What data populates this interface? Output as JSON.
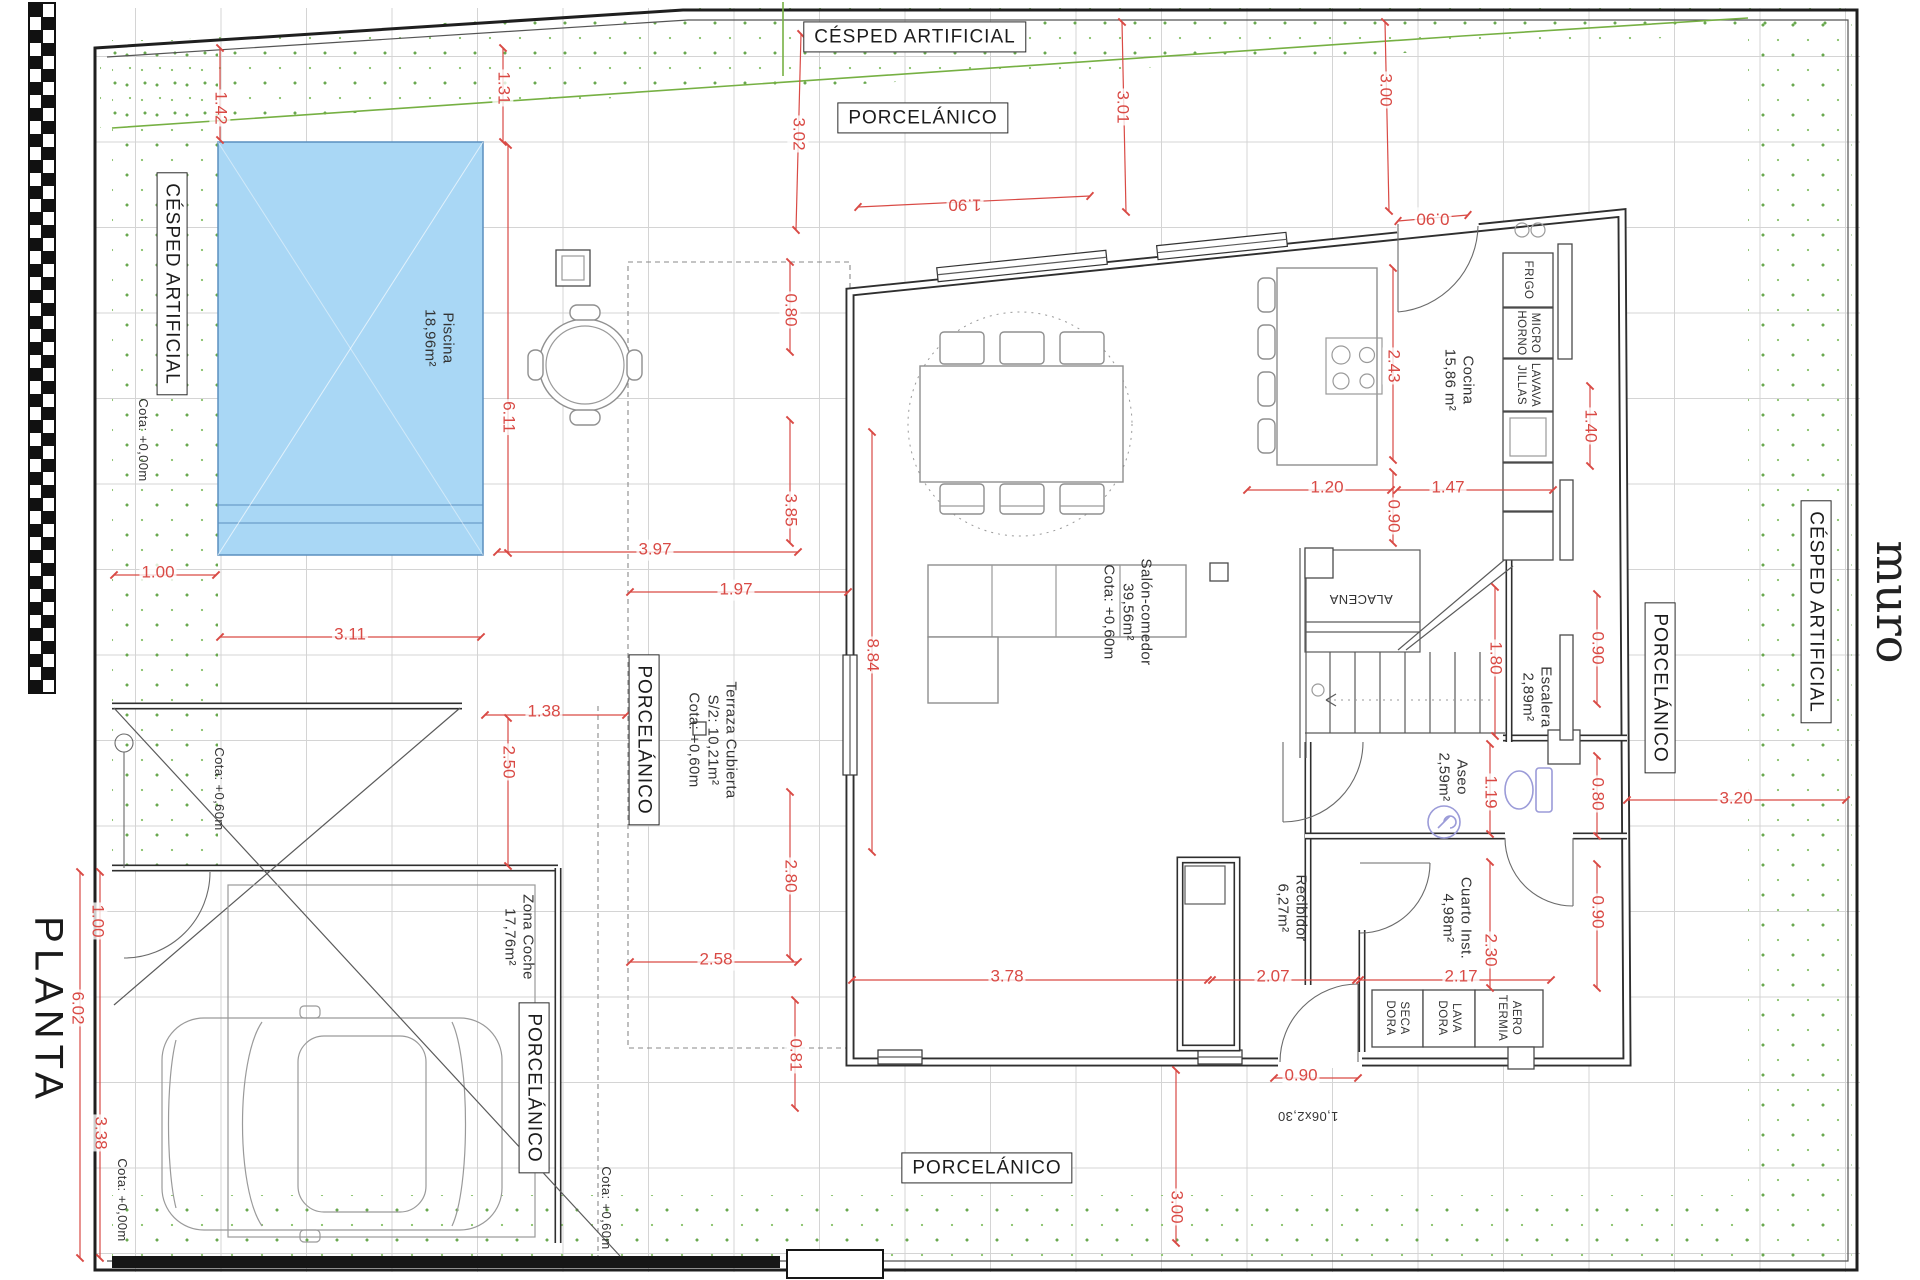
{
  "title": "PLANTA",
  "wall_label": "muro",
  "colors": {
    "dimension_red": "#d94a45",
    "grass_green": "#76b043",
    "pool_blue": "#a9d7f5",
    "wall_dark": "#2f2f2f"
  },
  "boxed_labels": [
    {
      "name": "cesped-artificial-top",
      "text": "CÉSPED ARTIFICIAL",
      "x": 915,
      "y": 37,
      "rot": 0
    },
    {
      "name": "porcelanico-top",
      "text": "PORCELÁNICO",
      "x": 923,
      "y": 118,
      "rot": 0
    },
    {
      "name": "cesped-artificial-left",
      "text": "CÉSPED ARTIFICIAL",
      "x": 172,
      "y": 284,
      "rot": 90
    },
    {
      "name": "porcelanico-terrace",
      "text": "PORCELÁNICO",
      "x": 644,
      "y": 740,
      "rot": 90
    },
    {
      "name": "porcelanico-garage",
      "text": "PORCELÁNICO",
      "x": 534,
      "y": 1088,
      "rot": 90
    },
    {
      "name": "porcelanico-right",
      "text": "PORCELÁNICO",
      "x": 1660,
      "y": 688,
      "rot": 90
    },
    {
      "name": "cesped-artificial-right",
      "text": "CÉSPED ARTIFICIAL",
      "x": 1816,
      "y": 612,
      "rot": 90
    },
    {
      "name": "porcelanico-bottom",
      "text": "PORCELÁNICO",
      "x": 987,
      "y": 1168,
      "rot": 0
    }
  ],
  "area_labels": [
    {
      "name": "label-piscina",
      "lines": [
        "Piscina",
        "18,96m²"
      ],
      "x": 438,
      "y": 338,
      "rot": 90
    },
    {
      "name": "label-cocina",
      "lines": [
        "Cocina",
        "15,86 m²"
      ],
      "x": 1458,
      "y": 380,
      "rot": 90
    },
    {
      "name": "label-salon-comedor",
      "lines": [
        "Salón-comedor",
        "39,56m²",
        "Cota: +0,60m"
      ],
      "x": 1127,
      "y": 612,
      "rot": 90
    },
    {
      "name": "label-terraza",
      "lines": [
        "Terraza Cubierta",
        "S/2: 10,21m²",
        "Cota: +0,60m"
      ],
      "x": 712,
      "y": 740,
      "rot": 90
    },
    {
      "name": "label-escalera",
      "lines": [
        "Escalera",
        "2,89m²"
      ],
      "x": 1536,
      "y": 697,
      "rot": 90
    },
    {
      "name": "label-aseo",
      "lines": [
        "Aseo",
        "2,59m²"
      ],
      "x": 1452,
      "y": 777,
      "rot": 90
    },
    {
      "name": "label-cuarto-inst",
      "lines": [
        "Cuarto Inst.",
        "4,98m²"
      ],
      "x": 1456,
      "y": 918,
      "rot": 90
    },
    {
      "name": "label-recibidor",
      "lines": [
        "Recibidor",
        "6,27m²"
      ],
      "x": 1291,
      "y": 908,
      "rot": 90
    },
    {
      "name": "label-zona-coche",
      "lines": [
        "Zona Coche",
        "17,76m²"
      ],
      "x": 518,
      "y": 937,
      "rot": 90
    },
    {
      "name": "label-alacena",
      "lines": [
        "ALACENA"
      ],
      "x": 1361,
      "y": 599,
      "rot": 180,
      "cls": "sm"
    },
    {
      "name": "label-frigo",
      "lines": [
        "FRIGO"
      ],
      "x": 1528,
      "y": 280,
      "rot": 90,
      "cls": "xs"
    },
    {
      "name": "label-micro-horno",
      "lines": [
        "MICRO",
        "HORNO"
      ],
      "x": 1528,
      "y": 333,
      "rot": 90,
      "cls": "xs"
    },
    {
      "name": "label-lavavajillas",
      "lines": [
        "LAVAVA",
        "JILLAS"
      ],
      "x": 1528,
      "y": 385,
      "rot": 90,
      "cls": "xs"
    },
    {
      "name": "label-secadora",
      "lines": [
        "SECA",
        "DORA"
      ],
      "x": 1397,
      "y": 1018,
      "rot": 90,
      "cls": "xs"
    },
    {
      "name": "label-lavadora",
      "lines": [
        "LAVA",
        "DORA"
      ],
      "x": 1449,
      "y": 1018,
      "rot": 90,
      "cls": "xs"
    },
    {
      "name": "label-aerotermia",
      "lines": [
        "AERO",
        "TERMIA"
      ],
      "x": 1509,
      "y": 1018,
      "rot": 90,
      "cls": "xs"
    },
    {
      "name": "label-cota-left",
      "lines": [
        "Cota: +0,00m"
      ],
      "x": 143,
      "y": 440,
      "rot": 90,
      "cls": "sm"
    },
    {
      "name": "label-cota-garage",
      "lines": [
        "Cota: +0,60m"
      ],
      "x": 219,
      "y": 789,
      "rot": 90,
      "cls": "sm"
    },
    {
      "name": "label-cota-bottom-left",
      "lines": [
        "Cota: +0,00m"
      ],
      "x": 122,
      "y": 1200,
      "rot": 90,
      "cls": "sm"
    },
    {
      "name": "label-cota-bottom-mid",
      "lines": [
        "Cota: +0,60m"
      ],
      "x": 606,
      "y": 1208,
      "rot": 90,
      "cls": "sm"
    },
    {
      "name": "label-door-size",
      "lines": [
        "1,06x2,30"
      ],
      "x": 1308,
      "y": 1116,
      "rot": 180,
      "cls": "sm"
    }
  ],
  "dimension_labels": [
    {
      "text": "1.42",
      "x": 220,
      "y": 108,
      "rot": 90
    },
    {
      "text": "1.31",
      "x": 503,
      "y": 88,
      "rot": 90
    },
    {
      "text": "3.02",
      "x": 798,
      "y": 134,
      "rot": 90
    },
    {
      "text": "3.01",
      "x": 1122,
      "y": 107,
      "rot": 90
    },
    {
      "text": "3.00",
      "x": 1385,
      "y": 90,
      "rot": 90
    },
    {
      "text": "1.90",
      "x": 965,
      "y": 204,
      "rot": 180
    },
    {
      "text": "0.90",
      "x": 1433,
      "y": 218,
      "rot": 180
    },
    {
      "text": "0.80",
      "x": 790,
      "y": 310,
      "rot": 90
    },
    {
      "text": "2.43",
      "x": 1393,
      "y": 366,
      "rot": 90
    },
    {
      "text": "1.40",
      "x": 1590,
      "y": 426,
      "rot": 90
    },
    {
      "text": "6.11",
      "x": 508,
      "y": 417,
      "rot": 90
    },
    {
      "text": "3.85",
      "x": 790,
      "y": 510,
      "rot": 90
    },
    {
      "text": "3.97",
      "x": 655,
      "y": 550,
      "rot": 0
    },
    {
      "text": "1.97",
      "x": 736,
      "y": 590,
      "rot": 0
    },
    {
      "text": "1.20",
      "x": 1327,
      "y": 488,
      "rot": 0
    },
    {
      "text": "0.90",
      "x": 1393,
      "y": 516,
      "rot": 90
    },
    {
      "text": "1.47",
      "x": 1448,
      "y": 488,
      "rot": 0
    },
    {
      "text": "1.00",
      "x": 158,
      "y": 573,
      "rot": 0
    },
    {
      "text": "3.11",
      "x": 350,
      "y": 635,
      "rot": 0
    },
    {
      "text": "8.84",
      "x": 872,
      "y": 655,
      "rot": 90
    },
    {
      "text": "1.38",
      "x": 544,
      "y": 712,
      "rot": 0
    },
    {
      "text": "2.50",
      "x": 508,
      "y": 762,
      "rot": 90
    },
    {
      "text": "1.80",
      "x": 1495,
      "y": 658,
      "rot": 90
    },
    {
      "text": "0.90",
      "x": 1597,
      "y": 648,
      "rot": 90
    },
    {
      "text": "2.80",
      "x": 790,
      "y": 876,
      "rot": 90
    },
    {
      "text": "1.19",
      "x": 1490,
      "y": 792,
      "rot": 90
    },
    {
      "text": "0.80",
      "x": 1597,
      "y": 794,
      "rot": 90
    },
    {
      "text": "3.20",
      "x": 1736,
      "y": 799,
      "rot": 0
    },
    {
      "text": "2.58",
      "x": 716,
      "y": 960,
      "rot": 0
    },
    {
      "text": "0.90",
      "x": 1597,
      "y": 912,
      "rot": 90
    },
    {
      "text": "2.30",
      "x": 1490,
      "y": 950,
      "rot": 90
    },
    {
      "text": "3.78",
      "x": 1007,
      "y": 977,
      "rot": 0
    },
    {
      "text": "2.07",
      "x": 1273,
      "y": 977,
      "rot": 0
    },
    {
      "text": "2.17",
      "x": 1461,
      "y": 977,
      "rot": 0
    },
    {
      "text": "0.81",
      "x": 795,
      "y": 1055,
      "rot": 90
    },
    {
      "text": "0.90",
      "x": 1301,
      "y": 1076,
      "rot": 0
    },
    {
      "text": "1.00",
      "x": 97,
      "y": 921,
      "rot": 90
    },
    {
      "text": "6.02",
      "x": 77,
      "y": 1008,
      "rot": 90
    },
    {
      "text": "3.38",
      "x": 100,
      "y": 1133,
      "rot": 90
    },
    {
      "text": "3.00",
      "x": 1176,
      "y": 1207,
      "rot": 90
    }
  ]
}
